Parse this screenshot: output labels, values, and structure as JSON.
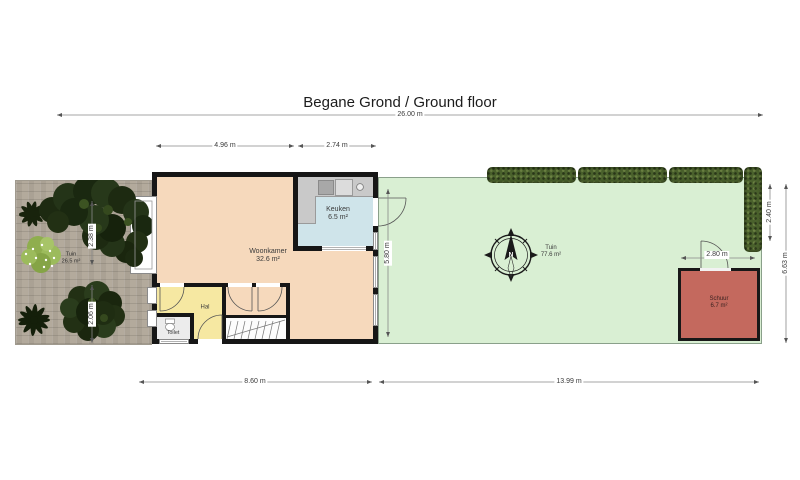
{
  "title": "Begane Grond / Ground floor",
  "dimensions": {
    "total_width": "26.00 m",
    "living_width": "4.96 m",
    "kitchen_width": "2.74 m",
    "house_width": "8.60 m",
    "garden_width": "13.99 m",
    "garden_depth": "5.80 m",
    "hedge_depth": "2.40 m",
    "garden_full_depth": "6.63 m",
    "shed_width": "2.80 m",
    "front_garden_upper": "2.38 m",
    "front_garden_lower": "2.06 m"
  },
  "rooms": {
    "woonkamer": {
      "name": "Woonkamer",
      "area": "32.6 m²"
    },
    "keuken": {
      "name": "Keuken",
      "area": "6.5 m²"
    },
    "hal": {
      "name": "Hal"
    },
    "toilet": {
      "name": "Toilet"
    },
    "front_garden": {
      "name": "Tuin",
      "area": "26.5 m²"
    },
    "back_garden": {
      "name": "Tuin",
      "area": "77.6 m²"
    },
    "schuur": {
      "name": "Schuur",
      "area": "6.7 m²"
    }
  },
  "compass": {
    "north": "N"
  },
  "colors": {
    "woonkamer": "#f6d9bc",
    "keuken": "#cfe4ea",
    "hal": "#f6e8a2",
    "toilet": "#ececec",
    "back_garden": "#d9efd3",
    "schuur": "#c4695e",
    "hedge": "#4a612c",
    "paving": "#b3aa9c",
    "walls": "#161616"
  }
}
